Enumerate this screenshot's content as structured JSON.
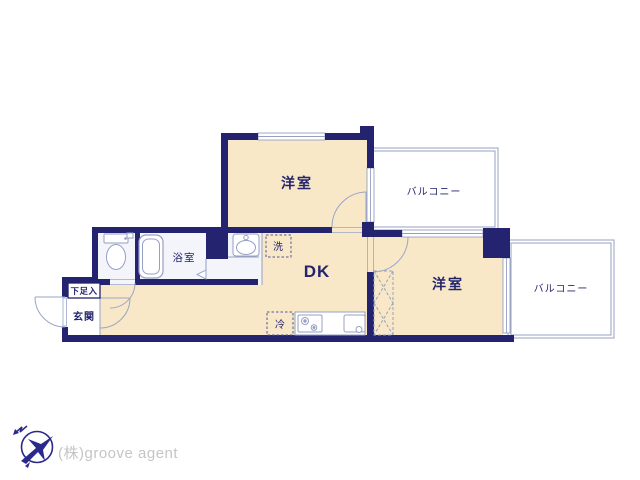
{
  "floor_plan": {
    "labels": {
      "upper_room": "洋室",
      "right_room": "洋室",
      "upper_balcony": "バルコニー",
      "right_balcony": "バルコニー",
      "bathroom": "浴室",
      "dining_kitchen": "DK",
      "entrance": "玄関",
      "shoe_cabinet": "下足入",
      "washing_machine": "洗",
      "refrigerator": "冷"
    },
    "colors": {
      "wall": "#232370",
      "room_fill": "#f8e8c8",
      "wet_area_fill": "#f3f5fb",
      "fixture_line": "#96a0c2",
      "label_text": "#23236e",
      "appliance_dash": "#5058a0"
    },
    "icons": {
      "bathtub": "bathtub-icon",
      "toilet": "toilet-icon",
      "washbasin": "washbasin-icon",
      "stove": "stove-icon",
      "kitchen_sink": "kitchen-sink-icon",
      "closet_cross": "closet-x-icon"
    }
  },
  "footer": {
    "company": "(株)groove agent",
    "logo_icon": "compass-bird",
    "logo_color": "#2a2a8c",
    "text_color": "#c5c5c5"
  }
}
